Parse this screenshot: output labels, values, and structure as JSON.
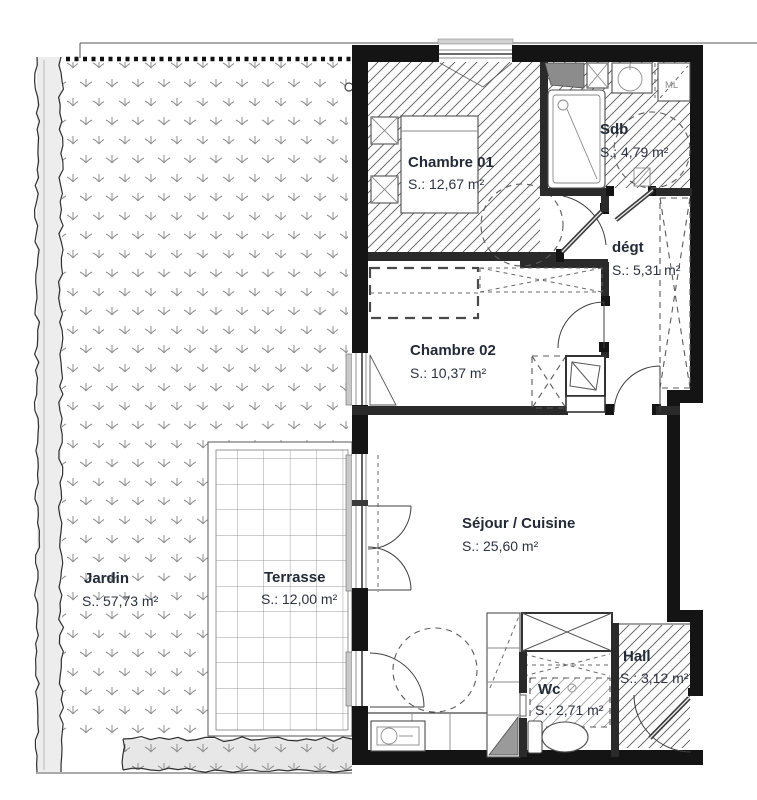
{
  "plan": {
    "rooms": [
      {
        "name": "Chambre 01",
        "area": "S.: 12,67 m²"
      },
      {
        "name": "Sdb",
        "area": "S.: 4,79 m²"
      },
      {
        "name": "dégt",
        "area": "S.: 5,31 m²"
      },
      {
        "name": "Chambre 02",
        "area": "S.: 10,37 m²"
      },
      {
        "name": "Séjour / Cuisine",
        "area": "S.: 25,60 m²"
      },
      {
        "name": "Wc",
        "area": "S.: 2,71 m²"
      },
      {
        "name": "Hall",
        "area": "S.: 3,12 m²"
      },
      {
        "name": "Terrasse",
        "area": "S.: 12,00 m²"
      },
      {
        "name": "Jardin",
        "area": "S.: 57,73 m²"
      }
    ],
    "appliances": {
      "washing_machine": "ML"
    },
    "colors": {
      "wall": "#141414",
      "label": "#232b38",
      "hatch": "#5c5c5c",
      "grass": "#8f8f8f",
      "hedge_fill": "#ededed",
      "paper": "#ffffff"
    }
  }
}
